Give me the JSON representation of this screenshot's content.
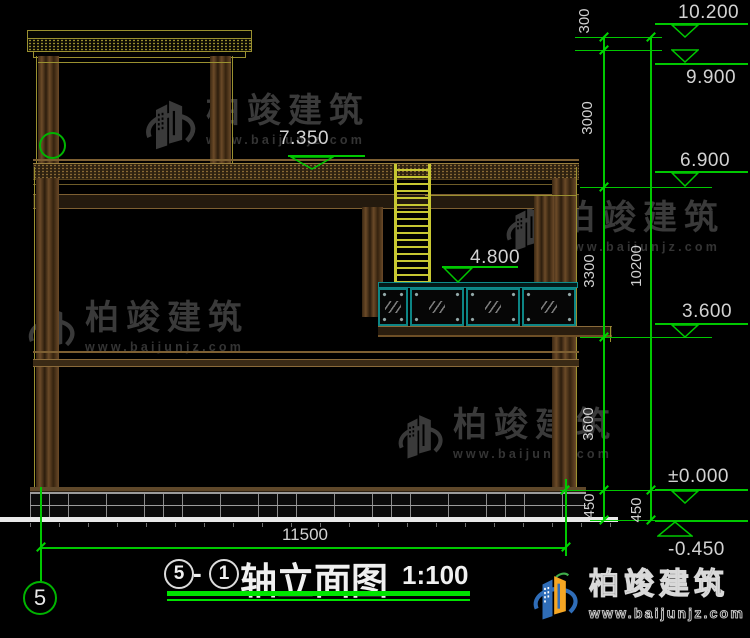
{
  "drawing": {
    "levels": {
      "l10200": "10.200",
      "l9900": "9.900",
      "l7350": "7.350",
      "l6900": "6.900",
      "l4800": "4.800",
      "l3600": "3.600",
      "l0": "±0.000",
      "lm450": "-0.450"
    },
    "dims": {
      "d300": "300",
      "d3000": "3000",
      "d3300": "3300",
      "d3600": "3600",
      "d450a": "450",
      "d450b": "450",
      "d10200": "10200",
      "d11500": "11500"
    },
    "axis": {
      "bubble": "5"
    }
  },
  "title_block": {
    "axis_a": "5",
    "dash": "-",
    "axis_b": "1",
    "name": "轴立面图",
    "scale": "1:100"
  },
  "watermark": {
    "brand": "柏竣建筑",
    "url": "www.baijunjz.com"
  },
  "footer_logo": {
    "brand": "柏竣建筑",
    "url": "www.baijunjz.com"
  },
  "colors": {
    "dimension_green": "#00c800",
    "underline_green": "#00e400",
    "teal_frame": "#0d8585",
    "column_brown": "#6b4a28",
    "line_olive": "#9a9030",
    "ladder_yellow": "#c8c832",
    "logo_blue": "#2f6db8",
    "logo_orange": "#f5a623"
  }
}
